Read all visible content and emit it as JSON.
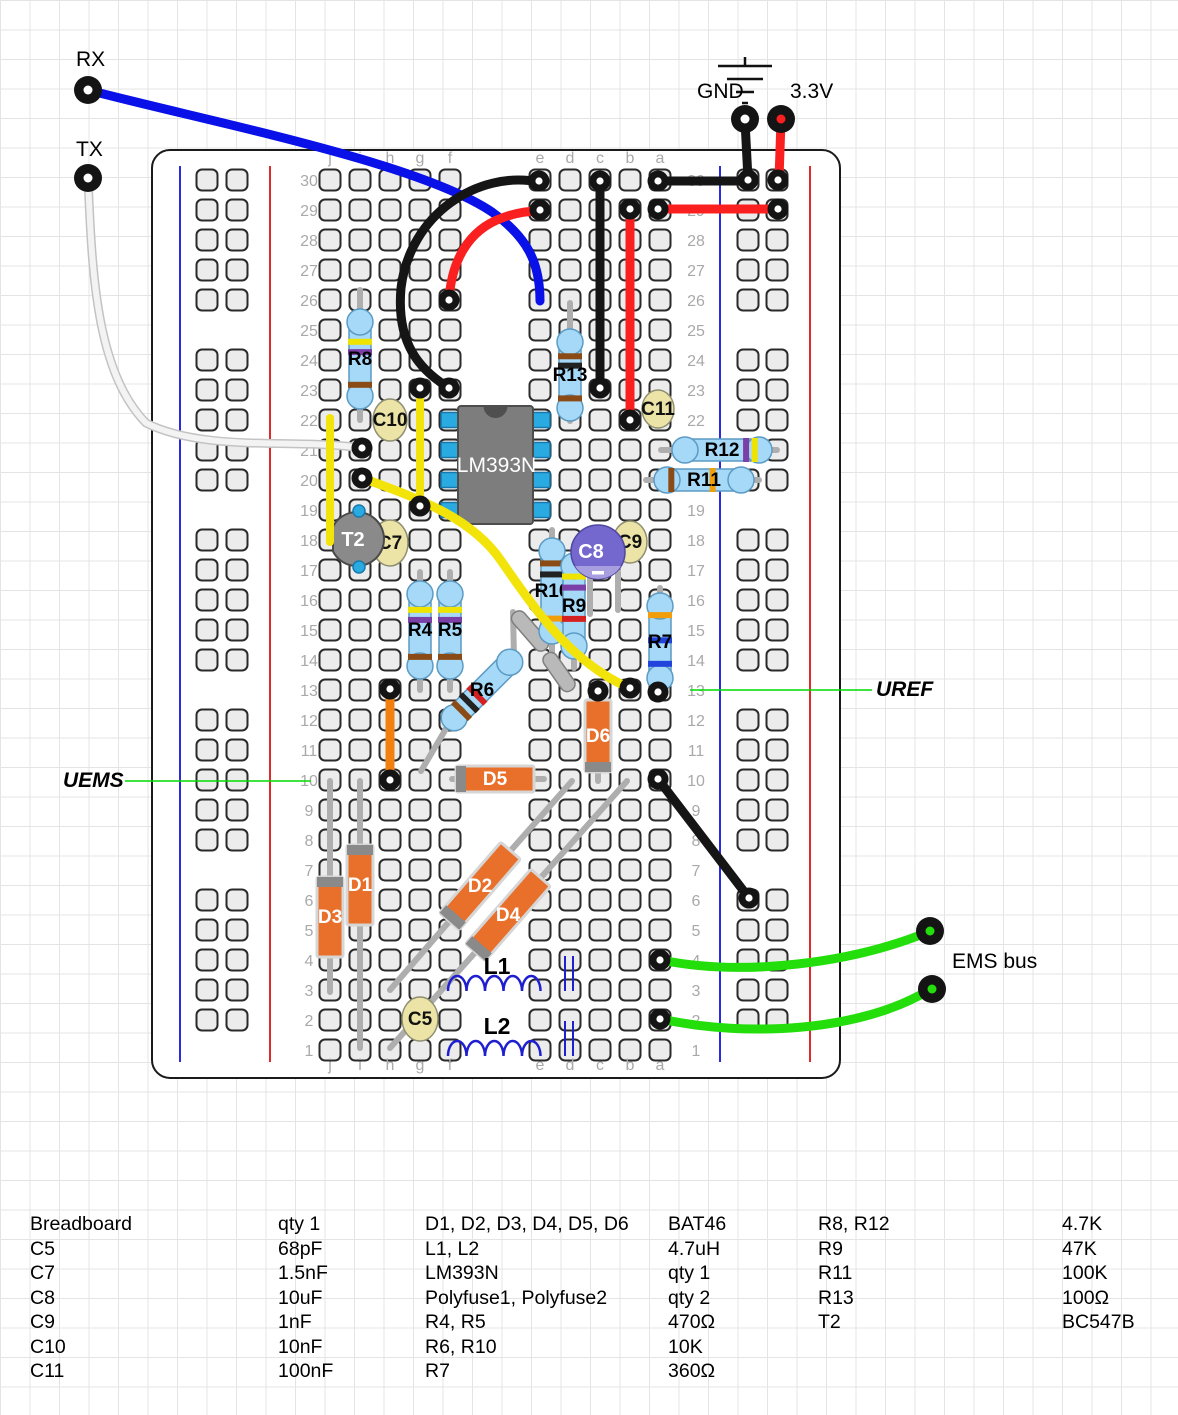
{
  "labels": {
    "rx": "RX",
    "tx": "TX",
    "gnd": "GND",
    "v33": "3.3V",
    "ems_bus": "EMS bus",
    "uref": "UREF",
    "uems": "UEMS"
  },
  "colors": {
    "wire_blue": "#0a10e8",
    "wire_red": "#fb2020",
    "wire_black": "#151515",
    "wire_yellow": "#f2e40a",
    "wire_green": "#23de0b",
    "wire_orange": "#f28011",
    "wire_white": "#f3f3f3",
    "wire_white_edge": "#c3c3c3",
    "lead": "#aeaeae",
    "hole_fill": "#ececec",
    "hole_stroke": "#2a2a2a",
    "rail_blue": "#2a2ae0",
    "rail_red": "#e02a2a",
    "board_stroke": "#1a1a1a",
    "board_fill": "#ffffff",
    "resistor_body": "#a6d9f7",
    "resistor_edge": "#5b9bc4",
    "diode_body": "#e8702a",
    "diode_edge": "#d6d6d6",
    "diode_band": "#8a8a8a",
    "cap_body": "#ece3a6",
    "cap_edge": "#8f8f72",
    "c8_body": "#7468cf",
    "c8_band": "#a79ee0",
    "ic_body": "#7d7d7d",
    "ic_notch": "#4f4f4f",
    "ic_pin": "#29abe2",
    "ic_pin_edge": "#1878ad",
    "transistor_body": "#8a8a8a",
    "transistor_edge": "#4a4a4a",
    "transistor_leg": "#29abe2",
    "annot_green": "#00dc00",
    "index_text": "#a9a9a9",
    "coil_blue": "#1f1fd0"
  },
  "board": {
    "x": 152,
    "y": 150,
    "w": 688,
    "h": 928,
    "rows": 30,
    "row0_y": 180,
    "pitch": 30,
    "col_x": [
      330,
      360,
      390,
      420,
      450,
      540,
      570,
      600,
      630,
      660
    ],
    "letters": [
      "j",
      "i",
      "h",
      "g",
      "f",
      "e",
      "d",
      "c",
      "b",
      "a"
    ],
    "num_x_left": 309,
    "num_x_right": 696,
    "letter_y_top": 157,
    "letter_y_bottom": 1064,
    "rails": {
      "y0": 180,
      "groups": 5,
      "per_group": 5,
      "group_pitch": 180,
      "pitch": 30,
      "left": {
        "blue_x": 180,
        "red_x": 270,
        "hole_x": [
          207,
          237
        ]
      },
      "right": {
        "blue_x": 720,
        "red_x": 810,
        "hole_x": [
          748,
          777
        ]
      }
    }
  },
  "resistors": [
    {
      "label": "R8",
      "x1": 360,
      "y1": 316,
      "x2": 360,
      "y2": 402,
      "label_rot": -90,
      "bands": [
        {
          "t": 0.3,
          "c": "#efe400"
        },
        {
          "t": 0.42,
          "c": "#7b3fa8"
        },
        {
          "t": 0.8,
          "c": "#8a4b16"
        }
      ],
      "leads": [
        [
          360,
          290,
          360,
          316
        ],
        [
          360,
          402,
          360,
          420
        ]
      ]
    },
    {
      "label": "R13",
      "x1": 570,
      "y1": 336,
      "x2": 570,
      "y2": 414,
      "label_rot": -90,
      "bands": [
        {
          "t": 0.26,
          "c": "#8a4b16"
        },
        {
          "t": 0.38,
          "c": "#222222"
        },
        {
          "t": 0.8,
          "c": "#8a4b16"
        }
      ],
      "leads": [
        [
          570,
          303,
          570,
          336
        ],
        [
          570,
          414,
          570,
          421
        ]
      ]
    },
    {
      "label": "R12",
      "x1": 679,
      "y1": 450,
      "x2": 765,
      "y2": 450,
      "label_rot": 0,
      "bands": [
        {
          "t": 0.78,
          "c": "#7b3fa8"
        },
        {
          "t": 0.88,
          "c": "#efe400"
        }
      ],
      "leads": [
        [
          661,
          450,
          679,
          450
        ],
        [
          765,
          450,
          777,
          450
        ]
      ]
    },
    {
      "label": "R11",
      "x1": 661,
      "y1": 480,
      "x2": 747,
      "y2": 480,
      "label_rot": 0,
      "bands": [
        {
          "t": 0.12,
          "c": "#8a4b16"
        },
        {
          "t": 0.6,
          "c": "#f29e0a"
        }
      ],
      "leads": [
        [
          646,
          480,
          661,
          480
        ],
        [
          747,
          480,
          759,
          480
        ]
      ]
    },
    {
      "label": "R4",
      "x1": 420,
      "y1": 588,
      "x2": 420,
      "y2": 672,
      "label_rot": -90,
      "bands": [
        {
          "t": 0.26,
          "c": "#efe400"
        },
        {
          "t": 0.38,
          "c": "#7b3fa8"
        },
        {
          "t": 0.82,
          "c": "#8a4b16"
        }
      ],
      "leads": [
        [
          420,
          572,
          420,
          588
        ],
        [
          420,
          672,
          420,
          690
        ]
      ]
    },
    {
      "label": "R5",
      "x1": 450,
      "y1": 588,
      "x2": 450,
      "y2": 672,
      "label_rot": -90,
      "bands": [
        {
          "t": 0.26,
          "c": "#efe400"
        },
        {
          "t": 0.38,
          "c": "#7b3fa8"
        },
        {
          "t": 0.82,
          "c": "#8a4b16"
        }
      ],
      "leads": [
        [
          450,
          572,
          450,
          588
        ],
        [
          450,
          672,
          450,
          690
        ]
      ]
    },
    {
      "label": "R10",
      "x1": 552,
      "y1": 545,
      "x2": 552,
      "y2": 637,
      "label_rot": -90,
      "bands": [
        {
          "t": 0.2,
          "c": "#8a4b16"
        },
        {
          "t": 0.32,
          "c": "#222222"
        },
        {
          "t": 0.8,
          "c": "#f29e0a"
        }
      ],
      "leads": [
        [
          552,
          530,
          552,
          545
        ],
        [
          552,
          637,
          552,
          652
        ]
      ]
    },
    {
      "label": "R9",
      "x1": 574,
      "y1": 560,
      "x2": 574,
      "y2": 652,
      "label_rot": -90,
      "bands": [
        {
          "t": 0.18,
          "c": "#efe400"
        },
        {
          "t": 0.3,
          "c": "#7b3fa8"
        },
        {
          "t": 0.64,
          "c": "#d42020"
        }
      ],
      "leads": [
        [
          574,
          545,
          574,
          560
        ],
        [
          574,
          652,
          574,
          668
        ]
      ]
    },
    {
      "label": "R7",
      "x1": 660,
      "y1": 600,
      "x2": 660,
      "y2": 684,
      "label_rot": -90,
      "bands": [
        {
          "t": 0.18,
          "c": "#f29e0a"
        },
        {
          "t": 0.48,
          "c": "#2244dd"
        },
        {
          "t": 0.76,
          "c": "#2244dd"
        }
      ],
      "leads": [
        [
          660,
          588,
          660,
          600
        ],
        [
          660,
          684,
          660,
          695
        ]
      ]
    },
    {
      "label": "R6",
      "x1": 450,
      "y1": 722,
      "x2": 514,
      "y2": 658,
      "label_rot": -45,
      "bands": [
        {
          "t": 0.18,
          "c": "#8a4b16"
        },
        {
          "t": 0.3,
          "c": "#222222"
        },
        {
          "t": 0.42,
          "c": "#d42020"
        }
      ],
      "leads": [
        [
          421,
          771,
          450,
          722
        ],
        [
          514,
          658,
          513,
          612
        ]
      ]
    }
  ],
  "polyfuses": [
    {
      "label": "Polyfuse1",
      "cx": 530,
      "cy": 631,
      "len": 48,
      "w": 15,
      "angle": 49
    },
    {
      "label": "Polyfuse2",
      "cx": 559,
      "cy": 672,
      "len": 44,
      "w": 15,
      "angle": 55
    }
  ],
  "diodes": [
    {
      "label": "D1",
      "x1": 360,
      "y1": 852,
      "x2": 360,
      "y2": 918,
      "label_rot": -90,
      "leads": [
        [
          360,
          781,
          360,
          852
        ],
        [
          360,
          918,
          360,
          1048
        ]
      ]
    },
    {
      "label": "D3",
      "x1": 330,
      "y1": 884,
      "x2": 330,
      "y2": 950,
      "label_rot": -90,
      "leads": [
        [
          330,
          781,
          330,
          884
        ],
        [
          330,
          950,
          330,
          992
        ]
      ]
    },
    {
      "label": "D5",
      "x1": 463,
      "y1": 779,
      "x2": 527,
      "y2": 779,
      "label_rot": 0,
      "leads": [
        [
          452,
          779,
          463,
          779
        ],
        [
          527,
          779,
          544,
          779
        ]
      ]
    },
    {
      "label": "D6",
      "x1": 598,
      "y1": 765,
      "x2": 598,
      "y2": 707,
      "label_rot": -90,
      "leads": [
        [
          598,
          692,
          598,
          707
        ],
        [
          598,
          765,
          598,
          781
        ]
      ]
    },
    {
      "label": "D2",
      "x1": 454,
      "y1": 916,
      "x2": 506,
      "y2": 856,
      "label_rot": -49,
      "leads": [
        [
          572,
          781,
          506,
          856
        ],
        [
          454,
          916,
          390,
          990
        ]
      ]
    },
    {
      "label": "D4",
      "x1": 480,
      "y1": 947,
      "x2": 536,
      "y2": 883,
      "label_rot": -49,
      "leads": [
        [
          627,
          781,
          536,
          883
        ],
        [
          480,
          947,
          390,
          1048
        ]
      ]
    }
  ],
  "capacitors": [
    {
      "label": "C10",
      "cx": 390,
      "cy": 420,
      "rx": 17,
      "ry": 21
    },
    {
      "label": "C7",
      "cx": 390,
      "cy": 543,
      "rx": 18,
      "ry": 23
    },
    {
      "label": "C9",
      "cx": 630,
      "cy": 542,
      "rx": 17,
      "ry": 21
    },
    {
      "label": "C11",
      "cx": 658,
      "cy": 409,
      "rx": 16,
      "ry": 19
    },
    {
      "label": "C5",
      "cx": 420,
      "cy": 1019,
      "rx": 18,
      "ry": 22
    }
  ],
  "electrolytic": {
    "label": "C8",
    "cx": 598,
    "cy": 552,
    "r": 27,
    "minus": "-",
    "leads": [
      [
        590,
        575,
        590,
        614
      ],
      [
        618,
        572,
        618,
        610
      ]
    ]
  },
  "transistor": {
    "label": "T2",
    "cx": 357,
    "cy": 539,
    "r": 27,
    "legs": [
      [
        359,
        511
      ],
      [
        359,
        567
      ]
    ]
  },
  "ic": {
    "label": "LM393N",
    "x": 458,
    "y": 406,
    "w": 75,
    "h": 118,
    "pin_y": [
      420,
      450,
      480,
      510
    ],
    "pin_w": 18,
    "pin_h": 15
  },
  "inductors": [
    {
      "label": "L1",
      "coil_x": 448,
      "coil_y": 991,
      "humps": 5,
      "hump_w": 18.5,
      "hump_h": 15,
      "core": [
        [
          565,
          956,
          565,
          991
        ],
        [
          573,
          956,
          573,
          991
        ]
      ],
      "label_x": 497,
      "label_y": 974
    },
    {
      "label": "L2",
      "coil_x": 448,
      "coil_y": 1056,
      "humps": 5,
      "hump_w": 18.5,
      "hump_h": 15,
      "core": [
        [
          565,
          1021,
          565,
          1056
        ],
        [
          573,
          1021,
          573,
          1056
        ]
      ],
      "label_x": 497,
      "label_y": 1034
    }
  ],
  "wires": [
    {
      "name": "wire-rx-blue",
      "color": "wire_blue",
      "w": 9,
      "d": "M88,90 C210,122 418,162 492,212 C527,237 540,262 540,301"
    },
    {
      "name": "wire-tx-white",
      "color": "wire_white",
      "w": 6,
      "outline": true,
      "d": "M88,178 C92,272 96,372 146,423 C206,453 298,438 361,448"
    },
    {
      "name": "wire-black-jumper-top",
      "color": "wire_black",
      "w": 9,
      "d": "M539,182 C478,170 410,214 401,288 C396,344 420,370 449,388"
    },
    {
      "name": "wire-red-jumper-top",
      "color": "wire_red",
      "w": 9,
      "d": "M449,301 C451,262 468,230 502,218 C515,213 528,211 540,211"
    },
    {
      "name": "wire-black-col-c",
      "color": "wire_black",
      "w": 9,
      "d": "M600,182 L600,388"
    },
    {
      "name": "wire-red-col-b",
      "color": "wire_red",
      "w": 9,
      "d": "M630,209 L630,420"
    },
    {
      "name": "wire-black-row30",
      "color": "wire_black",
      "w": 9,
      "d": "M658,181 L748,181"
    },
    {
      "name": "wire-red-row29",
      "color": "wire_red",
      "w": 9,
      "d": "M658,209 L778,209"
    },
    {
      "name": "wire-gnd-drop",
      "color": "wire_black",
      "w": 9,
      "d": "M745,121 L748,179"
    },
    {
      "name": "wire-v33-drop",
      "color": "wire_red",
      "w": 9,
      "d": "M781,121 L779,179"
    },
    {
      "name": "wire-yellow-left",
      "color": "wire_yellow",
      "w": 8,
      "d": "M330,418 L330,542"
    },
    {
      "name": "wire-yellow-mid",
      "color": "wire_yellow",
      "w": 8,
      "d": "M420,389 L420,506"
    },
    {
      "name": "wire-yellow-curve",
      "color": "wire_yellow",
      "w": 9,
      "d": "M362,478 C424,500 474,520 502,562 C538,614 572,662 627,687"
    },
    {
      "name": "wire-orange-jumper",
      "color": "wire_orange",
      "w": 9,
      "d": "M390,690 L390,779"
    },
    {
      "name": "wire-black-diagonal",
      "color": "wire_black",
      "w": 9,
      "d": "M658,779 L749,898"
    },
    {
      "name": "wire-green-ems-1",
      "color": "wire_green",
      "w": 9,
      "d": "M661,960 C745,977 852,963 928,932"
    },
    {
      "name": "wire-green-ems-2",
      "color": "wire_green",
      "w": 9,
      "d": "M661,1019 C748,1038 862,1031 929,990"
    }
  ],
  "annotation_lines": [
    {
      "name": "uems-pointer-line",
      "d": "M125,781 L311,781"
    },
    {
      "name": "uref-pointer-line",
      "d": "M690,690 L872,690"
    }
  ],
  "dots": [
    [
      539,
      181
    ],
    [
      540,
      210
    ],
    [
      449,
      300
    ],
    [
      449,
      388
    ],
    [
      420,
      388
    ],
    [
      420,
      506
    ],
    [
      362,
      448
    ],
    [
      362,
      478
    ],
    [
      600,
      181
    ],
    [
      600,
      388
    ],
    [
      630,
      209
    ],
    [
      630,
      420
    ],
    [
      658,
      181
    ],
    [
      658,
      209
    ],
    [
      748,
      180
    ],
    [
      778,
      180
    ],
    [
      778,
      209
    ],
    [
      598,
      691
    ],
    [
      630,
      688
    ],
    [
      658,
      692
    ],
    [
      390,
      689
    ],
    [
      390,
      780
    ],
    [
      658,
      779
    ],
    [
      749,
      898
    ],
    [
      660,
      960
    ],
    [
      660,
      1019
    ]
  ],
  "posts": [
    {
      "name": "rx-post",
      "x": 88,
      "y": 90,
      "center": "#ffffff"
    },
    {
      "name": "tx-post",
      "x": 88,
      "y": 178,
      "center": "#ffffff"
    },
    {
      "name": "gnd-post",
      "x": 745,
      "y": 119,
      "center": "#ffffff"
    },
    {
      "name": "v33-post",
      "x": 781,
      "y": 119,
      "center": "#fb2020"
    },
    {
      "name": "ems-post-1",
      "x": 930,
      "y": 931,
      "center": "#23de0b"
    },
    {
      "name": "ems-post-2",
      "x": 932,
      "y": 989,
      "center": "#23de0b"
    }
  ],
  "ground_symbol": {
    "stem": [
      745,
      57,
      745,
      66
    ],
    "bars": [
      [
        718,
        66,
        772,
        66
      ],
      [
        727,
        79,
        763,
        79
      ],
      [
        736,
        92,
        754,
        92
      ],
      [
        742,
        103,
        748,
        103
      ]
    ]
  },
  "table": {
    "col_x": [
      30,
      278,
      425,
      668,
      818,
      1062
    ],
    "columns": [
      [
        "Breadboard",
        "C5",
        "C7",
        "C8",
        "C9",
        "C10",
        "C11"
      ],
      [
        "qty 1",
        "68pF",
        "1.5nF",
        "10uF",
        "1nF",
        "10nF",
        "100nF"
      ],
      [
        "D1, D2, D3, D4, D5, D6",
        "L1, L2",
        "LM393N",
        "Polyfuse1, Polyfuse2",
        "R4, R5",
        "R6, R10",
        "R7"
      ],
      [
        "BAT46",
        "4.7uH",
        "qty 1",
        "qty 2",
        "470Ω",
        "10K",
        "360Ω"
      ],
      [
        "R8, R12",
        "R9",
        "R11",
        "R13",
        "T2",
        "",
        ""
      ],
      [
        "4.7K",
        "47K",
        "100K",
        "100Ω",
        "BC547B",
        "",
        ""
      ]
    ]
  }
}
